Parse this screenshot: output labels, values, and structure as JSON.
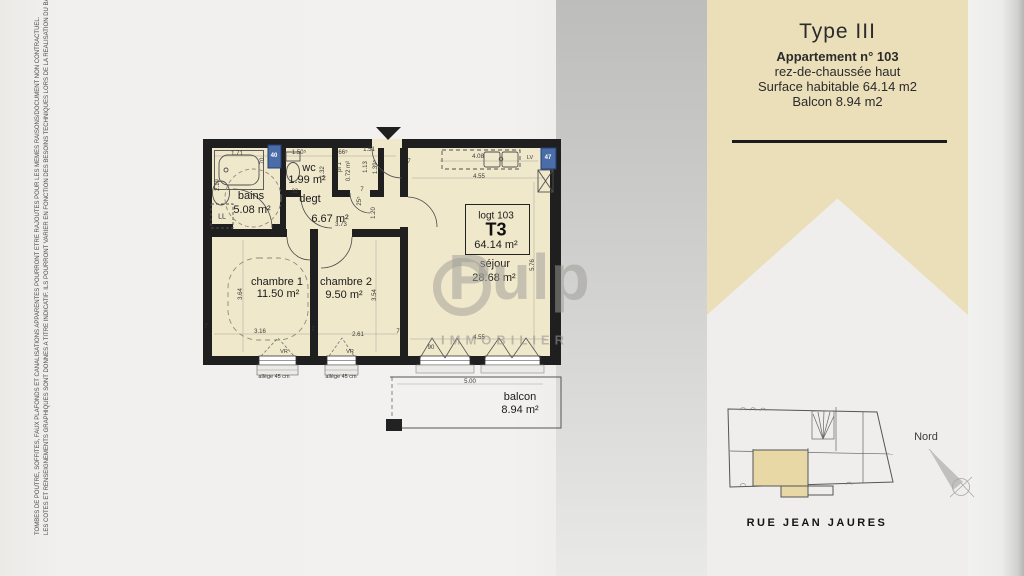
{
  "side_note": {
    "line1": "TOMBES DE POUTRE, SOFFITES, FAUX PLAFONDS ET CANALISATIONS APPARENTES POURRONT ETRE RAJOUTES POUR LES MEMES RAISONS/DOCUMENT NON CONTRACTUEL.",
    "line2": "LES COTES ET RENSEIGNEMENTS GRAPHIQUES SONT DONNES A TITRE INDICATIF. ILS POURRONT VARIER EN FONCTION DES BESOINS TECHNIQUES LORS DE LA REALISATION DU BATIMENT."
  },
  "banner": {
    "title": "Type III",
    "apartment": "Appartement n° 103",
    "floor": "rez-de-chaussée haut",
    "surface": "Surface habitable 64.14 m2",
    "balcony": "Balcon 8.94 m2"
  },
  "unit_box": {
    "line1": "logt 103",
    "line2": "T3",
    "line3": "64.14 m²"
  },
  "watermark": {
    "word": "Pulp",
    "sub": "IMMOBILIER"
  },
  "site": {
    "street": "RUE JEAN JAURES",
    "north": "Nord"
  },
  "colors": {
    "banner": "#ebdfba",
    "plan_fill": "#f0e8cb",
    "wall": "#1f1f1f",
    "window_box": "#4a6da8",
    "site_highlight": "#e7d8a6"
  },
  "texts": [
    {
      "t": "bains",
      "x": 251,
      "y": 196,
      "c": "room",
      "n": "room-label-bains"
    },
    {
      "t": "5.08 m²",
      "x": 252,
      "y": 210,
      "c": "area",
      "n": "room-area-bains"
    },
    {
      "t": "wc",
      "x": 309,
      "y": 168,
      "c": "room",
      "n": "room-label-wc"
    },
    {
      "t": "1.99 m²",
      "x": 307,
      "y": 180,
      "c": "area",
      "n": "room-area-wc"
    },
    {
      "t": "degt",
      "x": 310,
      "y": 199,
      "c": "room",
      "n": "room-label-degt"
    },
    {
      "t": "6.67 m²",
      "x": 330,
      "y": 219,
      "c": "area",
      "n": "room-area-degt"
    },
    {
      "t": "chambre 1",
      "x": 277,
      "y": 282,
      "c": "room",
      "n": "room-label-chambre1"
    },
    {
      "t": "11.50 m²",
      "x": 278,
      "y": 294,
      "c": "area",
      "n": "room-area-chambre1"
    },
    {
      "t": "chambre 2",
      "x": 346,
      "y": 282,
      "c": "room",
      "n": "room-label-chambre2"
    },
    {
      "t": "9.50 m²",
      "x": 344,
      "y": 295,
      "c": "area",
      "n": "room-area-chambre2"
    },
    {
      "t": "séjour",
      "x": 495,
      "y": 264,
      "c": "room",
      "n": "room-label-sejour"
    },
    {
      "t": "28.68 m²",
      "x": 494,
      "y": 278,
      "c": "area",
      "n": "room-area-sejour"
    },
    {
      "t": "balcon",
      "x": 520,
      "y": 397,
      "c": "room",
      "n": "room-label-balcon"
    },
    {
      "t": "8.94 m²",
      "x": 520,
      "y": 410,
      "c": "area",
      "n": "room-area-balcon"
    },
    {
      "t": "1.71",
      "x": 237,
      "y": 154,
      "c": "dim",
      "n": "dim"
    },
    {
      "t": "1.50⁵",
      "x": 299,
      "y": 153,
      "c": "dim",
      "n": "dim"
    },
    {
      "t": "66⁵",
      "x": 343,
      "y": 153,
      "c": "dim",
      "n": "dim"
    },
    {
      "t": "1.51",
      "x": 369,
      "y": 150,
      "c": "dim",
      "n": "dim"
    },
    {
      "t": "4.08",
      "x": 478,
      "y": 157,
      "c": "dim",
      "n": "dim"
    },
    {
      "t": "4.55",
      "x": 479,
      "y": 177,
      "c": "dim",
      "n": "dim"
    },
    {
      "t": "70",
      "x": 263,
      "y": 161,
      "c": "dim",
      "r": 1,
      "n": "dim"
    },
    {
      "t": "2.19",
      "x": 218,
      "y": 185,
      "c": "dim",
      "r": 1,
      "n": "dim"
    },
    {
      "t": "1.32",
      "x": 323,
      "y": 172,
      "c": "dim",
      "r": 1,
      "n": "dim"
    },
    {
      "t": "pl 1",
      "x": 340,
      "y": 167,
      "c": "dim",
      "r": 1,
      "n": "dim-placard"
    },
    {
      "t": "0.72 m²",
      "x": 349,
      "y": 171,
      "c": "dim",
      "r": 1,
      "n": "dim-placard-area"
    },
    {
      "t": "1.13",
      "x": 366,
      "y": 167,
      "c": "dim",
      "r": 1,
      "n": "dim"
    },
    {
      "t": "1.39⁵",
      "x": 376,
      "y": 167,
      "c": "dim",
      "r": 1,
      "n": "dim"
    },
    {
      "t": "25⁵",
      "x": 360,
      "y": 201,
      "c": "dim",
      "r": 1,
      "n": "dim"
    },
    {
      "t": "1.20",
      "x": 374,
      "y": 213,
      "c": "dim",
      "r": 1,
      "n": "dim"
    },
    {
      "t": "32",
      "x": 295,
      "y": 192,
      "c": "dim",
      "n": "dim"
    },
    {
      "t": "3.73",
      "x": 341,
      "y": 225,
      "c": "dim",
      "n": "dim"
    },
    {
      "t": "5.76",
      "x": 533,
      "y": 265,
      "c": "dim",
      "r": 1,
      "n": "dim"
    },
    {
      "t": "3.64",
      "x": 241,
      "y": 294,
      "c": "dim",
      "r": 1,
      "n": "dim"
    },
    {
      "t": "3.54",
      "x": 375,
      "y": 295,
      "c": "dim",
      "r": 1,
      "n": "dim"
    },
    {
      "t": "3.16",
      "x": 260,
      "y": 332,
      "c": "dim",
      "n": "dim"
    },
    {
      "t": "2.61",
      "x": 358,
      "y": 335,
      "c": "dim",
      "n": "dim"
    },
    {
      "t": "4.55",
      "x": 479,
      "y": 338,
      "c": "dim",
      "n": "dim"
    },
    {
      "t": "90",
      "x": 431,
      "y": 348,
      "c": "dim",
      "n": "dim-door-width"
    },
    {
      "t": "5.00",
      "x": 470,
      "y": 382,
      "c": "dim",
      "n": "dim-balcony"
    },
    {
      "t": "7",
      "x": 409,
      "y": 162,
      "c": "dim",
      "n": "dim"
    },
    {
      "t": "7",
      "x": 313,
      "y": 330,
      "c": "dim",
      "n": "dim"
    },
    {
      "t": "7",
      "x": 398,
      "y": 332,
      "c": "dim",
      "n": "dim"
    },
    {
      "t": "7",
      "x": 362,
      "y": 190,
      "c": "dim",
      "n": "dim"
    },
    {
      "t": "7",
      "x": 206,
      "y": 327,
      "c": "dim",
      "n": "dim"
    },
    {
      "t": "LL",
      "x": 222,
      "y": 217,
      "c": "small7",
      "n": "label-washing-machine"
    },
    {
      "t": "LV",
      "x": 530,
      "y": 158,
      "c": "tiny",
      "n": "label-dishwasher"
    },
    {
      "t": "VR",
      "x": 284,
      "y": 352,
      "c": "tiny",
      "n": "label-shutter"
    },
    {
      "t": "VR",
      "x": 350,
      "y": 352,
      "c": "tiny",
      "n": "label-shutter"
    },
    {
      "t": "allège 45 cm",
      "x": 274,
      "y": 377,
      "c": "tiny",
      "n": "label-sill-height"
    },
    {
      "t": "allège 45 cm",
      "x": 341,
      "y": 377,
      "c": "tiny",
      "n": "label-sill-height"
    },
    {
      "t": "40",
      "x": 274,
      "y": 156,
      "c": "wnum",
      "n": "window-number"
    },
    {
      "t": "47",
      "x": 548,
      "y": 158,
      "c": "wnum",
      "n": "window-number"
    }
  ]
}
